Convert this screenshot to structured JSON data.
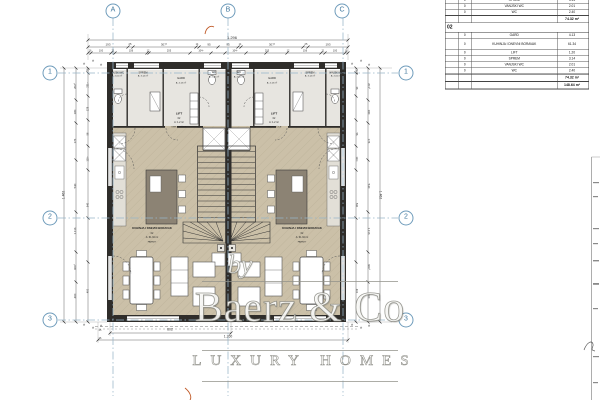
{
  "watermark": {
    "by": "by",
    "name": "Baerz & Co",
    "tagline": "LUXURY HOMES"
  },
  "area_table": {
    "partial_rows": [
      [
        "0",
        "SPREM",
        "3.14"
      ],
      [
        "0",
        "VANJSKI WC",
        "2.01"
      ],
      [
        "0",
        "WC",
        "2.40"
      ]
    ],
    "partial_total": "74.32 m²",
    "section": "02",
    "rows": [
      [
        "0",
        "GARD",
        "4.13"
      ],
      [
        "0",
        "KUHINJA I DNEVNI BORAVAK",
        "61.34"
      ],
      [
        "0",
        "LIFT",
        "1.20"
      ],
      [
        "0",
        "SPREM",
        "3.14"
      ],
      [
        "0",
        "VANJSKI WC",
        "2.01"
      ],
      [
        "0",
        "WC",
        "2.40"
      ]
    ],
    "section_total": "74.32 m²",
    "grand_total": "148.64 m²"
  },
  "grid_markers": [
    {
      "t": "A",
      "x": 113,
      "y": 11
    },
    {
      "t": "B",
      "x": 228,
      "y": 11
    },
    {
      "t": "C",
      "x": 342,
      "y": 11
    },
    {
      "t": "1",
      "x": 50,
      "y": 73
    },
    {
      "t": "2",
      "x": 50,
      "y": 218
    },
    {
      "t": "3",
      "x": 50,
      "y": 320
    },
    {
      "t": "1",
      "x": 406,
      "y": 73
    },
    {
      "t": "2",
      "x": 406,
      "y": 218
    },
    {
      "t": "3",
      "x": 406,
      "y": 320
    }
  ],
  "labels": [
    {
      "t": "1.296",
      "x": 232,
      "y": 37.5,
      "fs": 4
    },
    {
      "t": "193",
      "x": 108,
      "y": 44.5,
      "fs": 3
    },
    {
      "t": "25",
      "x": 130,
      "y": 44.5,
      "fs": 2.6
    },
    {
      "t": "307⁵",
      "x": 164,
      "y": 44.5,
      "fs": 3
    },
    {
      "t": "14",
      "x": 197,
      "y": 44.5,
      "fs": 2.4
    },
    {
      "t": "95",
      "x": 208.5,
      "y": 44.5,
      "fs": 3
    },
    {
      "t": "95",
      "x": 228,
      "y": 44.5,
      "fs": 3
    },
    {
      "t": "14",
      "x": 239.5,
      "y": 44.5,
      "fs": 2.4
    },
    {
      "t": "307⁵",
      "x": 272,
      "y": 44.5,
      "fs": 3
    },
    {
      "t": "25",
      "x": 306,
      "y": 44.5,
      "fs": 2.6
    },
    {
      "t": "193",
      "x": 328,
      "y": 44.5,
      "fs": 3
    },
    {
      "t": "16",
      "x": 90,
      "y": 50.5,
      "fs": 2.5
    },
    {
      "t": "100",
      "x": 101,
      "y": 50.5,
      "fs": 2.5
    },
    {
      "t": "21",
      "x": 113,
      "y": 50.5,
      "fs": 2.5
    },
    {
      "t": "156",
      "x": 131,
      "y": 50.5,
      "fs": 2.5
    },
    {
      "t": "12",
      "x": 148,
      "y": 50.5,
      "fs": 2.5
    },
    {
      "t": "205",
      "x": 169,
      "y": 50.5,
      "fs": 2.5
    },
    {
      "t": "104⁵",
      "x": 201,
      "y": 50.5,
      "fs": 2.5
    },
    {
      "t": "104⁵",
      "x": 235,
      "y": 50.5,
      "fs": 2.5
    },
    {
      "t": "205",
      "x": 267,
      "y": 50.5,
      "fs": 2.5
    },
    {
      "t": "12",
      "x": 288,
      "y": 50.5,
      "fs": 2.5
    },
    {
      "t": "156",
      "x": 305,
      "y": 50.5,
      "fs": 2.5
    },
    {
      "t": "21",
      "x": 323,
      "y": 50.5,
      "fs": 2.5
    },
    {
      "t": "100",
      "x": 335,
      "y": 50.5,
      "fs": 2.5
    },
    {
      "t": "16",
      "x": 346,
      "y": 50.5,
      "fs": 2.5
    },
    {
      "t": "1.462",
      "x": 64,
      "y": 195,
      "fs": 3.4,
      "r": -90
    },
    {
      "t": "202⁵",
      "x": 76,
      "y": 86,
      "fs": 2.8,
      "r": -90
    },
    {
      "t": "180",
      "x": 76,
      "y": 112,
      "fs": 2.8,
      "r": -90
    },
    {
      "t": "176",
      "x": 76,
      "y": 141,
      "fs": 2.8,
      "r": -90
    },
    {
      "t": "540",
      "x": 76,
      "y": 186,
      "fs": 2.8,
      "r": -90
    },
    {
      "t": "1.116",
      "x": 76,
      "y": 231,
      "fs": 2.8,
      "r": -90
    },
    {
      "t": "600⁵",
      "x": 76,
      "y": 267,
      "fs": 2.8,
      "r": -90
    },
    {
      "t": "400",
      "x": 76,
      "y": 296,
      "fs": 2.8,
      "r": -90
    },
    {
      "t": "25",
      "x": 88,
      "y": 70,
      "fs": 2.5,
      "r": -90
    },
    {
      "t": "231⁵",
      "x": 88,
      "y": 85,
      "fs": 2.5,
      "r": -90
    },
    {
      "t": "128",
      "x": 88,
      "y": 109,
      "fs": 2.5,
      "r": -90
    },
    {
      "t": "56",
      "x": 88,
      "y": 134,
      "fs": 2.5,
      "r": -90
    },
    {
      "t": "110⁵",
      "x": 88,
      "y": 159,
      "fs": 2.5,
      "r": -90
    },
    {
      "t": "540",
      "x": 88,
      "y": 205,
      "fs": 2.5,
      "r": -90
    },
    {
      "t": "400",
      "x": 88,
      "y": 291,
      "fs": 2.5,
      "r": -90
    },
    {
      "t": "1.462",
      "x": 380,
      "y": 195,
      "fs": 3.4,
      "r": 90
    },
    {
      "t": "201⁵",
      "x": 368,
      "y": 86,
      "fs": 2.8,
      "r": 90
    },
    {
      "t": "180",
      "x": 368,
      "y": 112,
      "fs": 2.8,
      "r": 90
    },
    {
      "t": "176",
      "x": 368,
      "y": 141,
      "fs": 2.8,
      "r": 90
    },
    {
      "t": "540",
      "x": 368,
      "y": 186,
      "fs": 2.8,
      "r": 90
    },
    {
      "t": "1.116",
      "x": 368,
      "y": 231,
      "fs": 2.8,
      "r": 90
    },
    {
      "t": "600⁵",
      "x": 368,
      "y": 267,
      "fs": 2.8,
      "r": 90
    },
    {
      "t": "400",
      "x": 368,
      "y": 296,
      "fs": 2.8,
      "r": 90
    },
    {
      "t": "128",
      "x": 356,
      "y": 72,
      "fs": 2.5,
      "r": 90
    },
    {
      "t": "26",
      "x": 356,
      "y": 88,
      "fs": 2.5,
      "r": 90
    },
    {
      "t": "56",
      "x": 356,
      "y": 134,
      "fs": 2.5,
      "r": 90
    },
    {
      "t": "110⁵",
      "x": 356,
      "y": 159,
      "fs": 2.5,
      "r": 90
    },
    {
      "t": "540",
      "x": 356,
      "y": 205,
      "fs": 2.5,
      "r": 90
    },
    {
      "t": "400",
      "x": 356,
      "y": 291,
      "fs": 2.5,
      "r": 90
    },
    {
      "t": "602",
      "x": 170,
      "y": 330,
      "fs": 3.4
    },
    {
      "t": "1.260",
      "x": 228,
      "y": 337,
      "fs": 3.4
    },
    {
      "t": "25",
      "x": 100,
      "y": 331,
      "fs": 2.4
    },
    {
      "t": "26",
      "x": 100,
      "y": 339,
      "fs": 2.4
    },
    {
      "t": "VANJSKI WC",
      "x": 117,
      "y": 72.5,
      "fs": 2.3,
      "c": "#222"
    },
    {
      "t": "A: 2.01 m²",
      "x": 117,
      "y": 76,
      "fs": 2.2,
      "c": "#222"
    },
    {
      "t": "SPREM",
      "x": 143,
      "y": 72.5,
      "fs": 2.5,
      "c": "#222"
    },
    {
      "t": "A: 3.14 m²",
      "x": 143,
      "y": 76.3,
      "fs": 2.2,
      "c": "#222"
    },
    {
      "t": "GARD",
      "x": 181,
      "y": 79,
      "fs": 2.7,
      "c": "#222"
    },
    {
      "t": "A: 4.13 m²",
      "x": 181,
      "y": 83,
      "fs": 2.2,
      "c": "#222"
    },
    {
      "t": "WC",
      "x": 214,
      "y": 73,
      "fs": 2.7,
      "c": "#222"
    },
    {
      "t": "A: 2.40 m²",
      "x": 214,
      "y": 77,
      "fs": 2.2,
      "c": "#222"
    },
    {
      "t": "VANJSKI WC",
      "x": 336,
      "y": 72.5,
      "fs": 2.3,
      "c": "#222"
    },
    {
      "t": "A: 2.01 m²",
      "x": 336,
      "y": 76,
      "fs": 2.2,
      "c": "#222"
    },
    {
      "t": "SPREM",
      "x": 310,
      "y": 72.5,
      "fs": 2.5,
      "c": "#222"
    },
    {
      "t": "A: 3.14 m²",
      "x": 310,
      "y": 76.3,
      "fs": 2.2,
      "c": "#222"
    },
    {
      "t": "GARD",
      "x": 272,
      "y": 79,
      "fs": 2.7,
      "c": "#222"
    },
    {
      "t": "A: 4.13 m²",
      "x": 272,
      "y": 83,
      "fs": 2.2,
      "c": "#222"
    },
    {
      "t": "WC",
      "x": 239,
      "y": 73,
      "fs": 2.7,
      "c": "#222"
    },
    {
      "t": "A: 2.40 m²",
      "x": 239,
      "y": 77,
      "fs": 2.2,
      "c": "#222"
    },
    {
      "t": "LIFT",
      "x": 179,
      "y": 114,
      "fs": 3,
      "b": 1,
      "c": "#222"
    },
    {
      "t": "02",
      "x": 179,
      "y": 118.5,
      "fs": 2.4,
      "c": "#222"
    },
    {
      "t": "A: 1.2 m²",
      "x": 179,
      "y": 122.5,
      "fs": 2.4,
      "c": "#222"
    },
    {
      "t": "KER.PLOČICE",
      "x": 179,
      "y": 126.5,
      "fs": 2.2,
      "c": "#222"
    },
    {
      "t": "LIFT",
      "x": 274,
      "y": 114,
      "fs": 3,
      "b": 1,
      "c": "#222"
    },
    {
      "t": "02",
      "x": 274,
      "y": 118.5,
      "fs": 2.4,
      "c": "#222"
    },
    {
      "t": "A: 1.2 m²",
      "x": 274,
      "y": 122.5,
      "fs": 2.4,
      "c": "#222"
    },
    {
      "t": "KER.PLOČICE",
      "x": 274,
      "y": 126.5,
      "fs": 2.2,
      "c": "#222"
    },
    {
      "t": "KUHINJA I DNEVNI BORAVAK",
      "x": 152,
      "y": 229,
      "fs": 2.8,
      "b": 1,
      "c": "#222"
    },
    {
      "t": "02",
      "x": 152,
      "y": 233.8,
      "fs": 2.4,
      "c": "#222"
    },
    {
      "t": "A: 61.34 m²",
      "x": 152,
      "y": 238,
      "fs": 2.4,
      "c": "#222"
    },
    {
      "t": "PARKET",
      "x": 152,
      "y": 242.3,
      "fs": 2.2,
      "c": "#222"
    },
    {
      "t": "KUHINJA I DNEVNI BORAVAK",
      "x": 302,
      "y": 229,
      "fs": 2.8,
      "b": 1,
      "c": "#222"
    },
    {
      "t": "02",
      "x": 302,
      "y": 233.8,
      "fs": 2.4,
      "c": "#222"
    },
    {
      "t": "A: 61.34 m²",
      "x": 302,
      "y": 238,
      "fs": 2.4,
      "c": "#222"
    },
    {
      "t": "PARKET",
      "x": 302,
      "y": 242.3,
      "fs": 2.2,
      "c": "#222"
    },
    {
      "t": "*",
      "x": 84,
      "y": 65,
      "fs": 6,
      "c": "#666"
    },
    {
      "t": "*",
      "x": 92.5,
      "y": 62,
      "fs": 6,
      "c": "#666"
    },
    {
      "t": "*",
      "x": 101,
      "y": 65.5,
      "fs": 6,
      "c": "#666"
    },
    {
      "t": "*",
      "x": 352,
      "y": 65,
      "fs": 6,
      "c": "#666"
    },
    {
      "t": "*",
      "x": 360.5,
      "y": 62,
      "fs": 6,
      "c": "#666"
    },
    {
      "t": "*",
      "x": 369,
      "y": 65.5,
      "fs": 6,
      "c": "#666"
    },
    {
      "t": "*",
      "x": 84,
      "y": 326,
      "fs": 6,
      "c": "#666"
    },
    {
      "t": "*",
      "x": 92.5,
      "y": 329,
      "fs": 6,
      "c": "#666"
    },
    {
      "t": "*",
      "x": 101,
      "y": 326.5,
      "fs": 6,
      "c": "#666"
    },
    {
      "t": "*",
      "x": 352,
      "y": 326,
      "fs": 6,
      "c": "#666"
    },
    {
      "t": "*",
      "x": 360.5,
      "y": 329,
      "fs": 6,
      "c": "#666"
    },
    {
      "t": "*",
      "x": 369,
      "y": 326.5,
      "fs": 6,
      "c": "#666"
    }
  ]
}
